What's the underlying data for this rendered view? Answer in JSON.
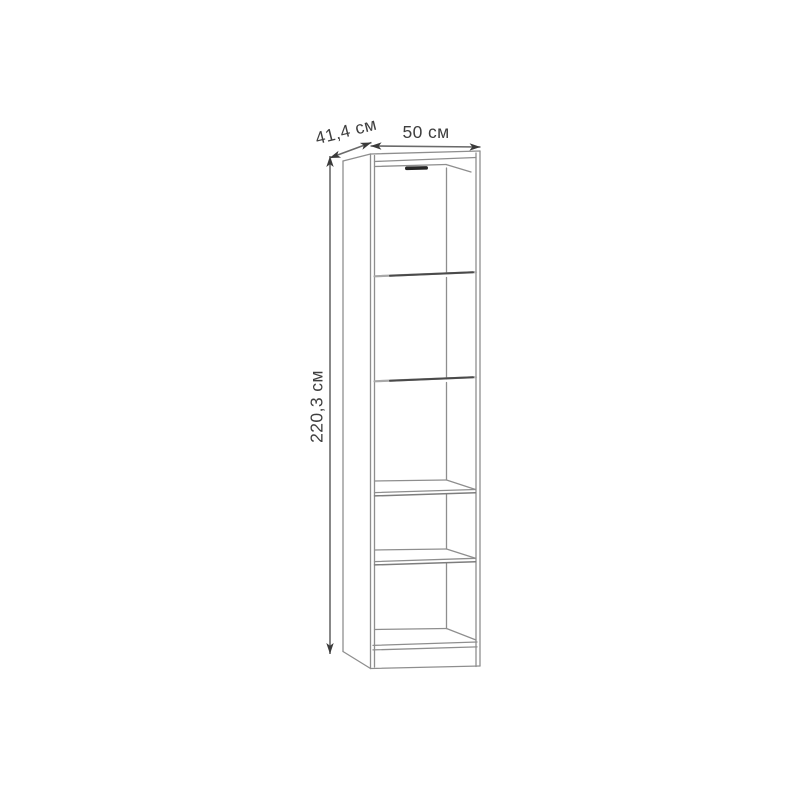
{
  "diagram": {
    "kind": "furniture dimension line drawing",
    "subject": "tall narrow open bookcase (5 compartments, 4 shelves) shown in slight perspective",
    "labels": {
      "depth": "41,4 см",
      "width": "50 см",
      "height": "220,3 см"
    },
    "colors": {
      "background": "#ffffff",
      "outline_line": "#8e8e8e",
      "shelf_edge_dark": "#4a4a4a",
      "top_hardware_slot": "#262626",
      "dimension_line": "#6a6a6a",
      "arrowhead": "#3a3a3a",
      "label_text": "#3f3f3f"
    }
  }
}
